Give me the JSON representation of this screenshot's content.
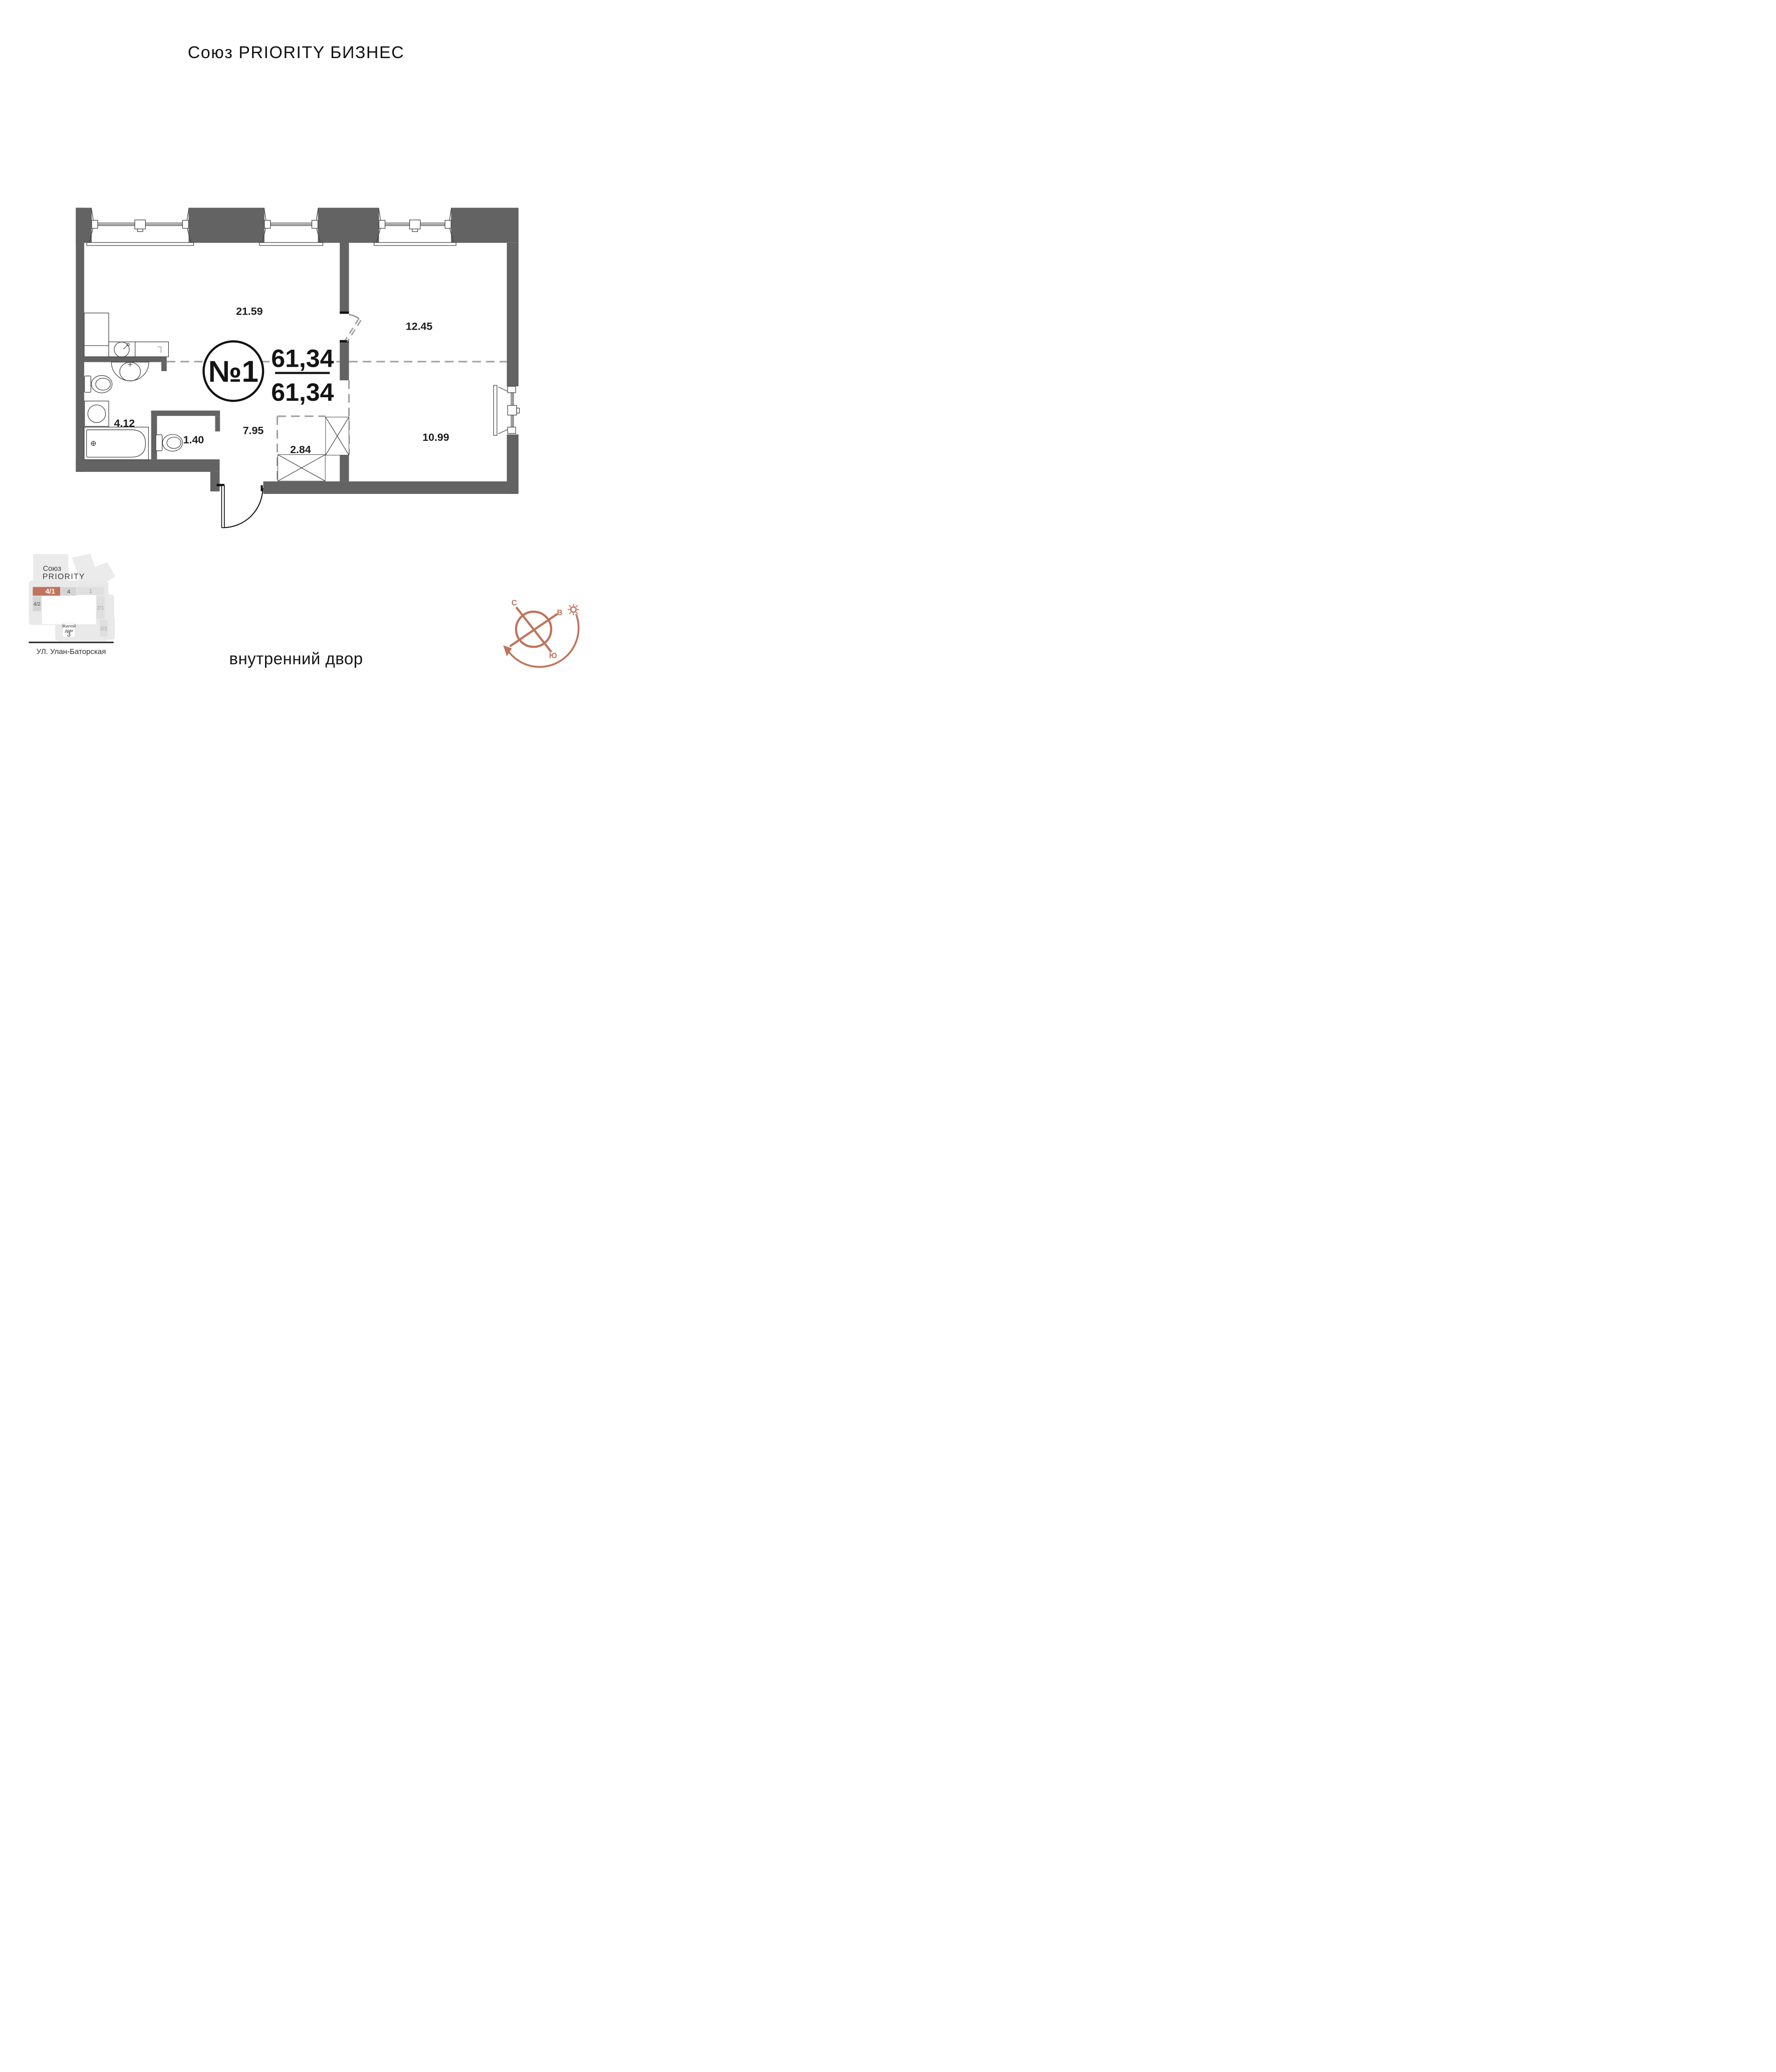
{
  "title": "Союз PRIORITY БИЗНЕС",
  "floor_plan": {
    "unit_number": "№1",
    "total_area": "61,34",
    "living_area": "61,34",
    "room_areas": {
      "living_kitchen": "21.59",
      "bedroom": "12.45",
      "hall": "7.95",
      "bathroom": "4.12",
      "wc": "1.40",
      "wardrobe": "2.84",
      "bedroom_second": "10.99"
    }
  },
  "site_map": {
    "project_name_line1": "Союз",
    "project_name_line2": "PRIORITY",
    "current_block": "4/1",
    "blocks": {
      "b4": "4",
      "b1": "1",
      "b42": "4/2",
      "b21": "2/1",
      "b22": "2/2"
    },
    "house_label_line1": "Жилой",
    "house_label_line2": "дом",
    "house_number": "3",
    "street": "УЛ. Улан-Баторская"
  },
  "compass": {
    "north": "С",
    "east": "В",
    "west": "З",
    "south": "Ю"
  },
  "footer_label": "внутренний двор",
  "colors": {
    "accent": "#c0745c",
    "walls": "#636363"
  }
}
